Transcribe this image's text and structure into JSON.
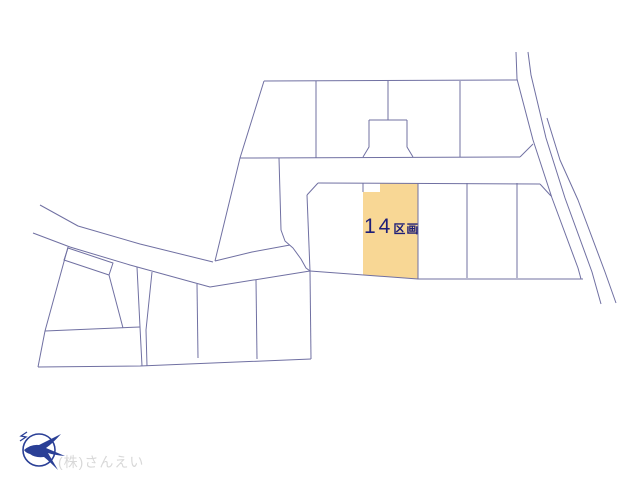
{
  "canvas": {
    "width": 640,
    "height": 480,
    "background": "#ffffff"
  },
  "colors": {
    "line": "#7070a2",
    "highlight_fill": "#f8d795",
    "label_color": "#1e1e78",
    "logo_color": "#2a3f96",
    "company_color": "#d8d8d8"
  },
  "parcel_label": {
    "number": "14",
    "suffix": "区画"
  },
  "footer": {
    "company_name": "(株)さんえい"
  },
  "plot_map": {
    "highlight_parcel": {
      "name": "parcel-14",
      "points": [
        [
          380,
          183
        ],
        [
          418,
          183
        ],
        [
          418,
          279
        ],
        [
          363,
          275
        ],
        [
          363,
          192
        ],
        [
          380,
          192
        ]
      ]
    },
    "lines": [
      {
        "name": "top-block-top-edge",
        "points": [
          [
            264,
            81
          ],
          [
            517,
            80
          ]
        ]
      },
      {
        "name": "top-block-left-edge",
        "points": [
          [
            264,
            81
          ],
          [
            240,
            158
          ],
          [
            215,
            261
          ]
        ]
      },
      {
        "name": "top-block-bottom-edge",
        "points": [
          [
            240,
            158
          ],
          [
            520,
            157
          ]
        ]
      },
      {
        "name": "top-block-corner-chamfer",
        "points": [
          [
            520,
            157
          ],
          [
            533,
            144
          ]
        ]
      },
      {
        "name": "top-block-divider-1",
        "points": [
          [
            316,
            81
          ],
          [
            316,
            158
          ]
        ]
      },
      {
        "name": "top-block-divider-2",
        "points": [
          [
            388,
            81
          ],
          [
            388,
            120
          ]
        ]
      },
      {
        "name": "flag-lot-top",
        "points": [
          [
            369,
            120
          ],
          [
            407,
            120
          ]
        ]
      },
      {
        "name": "flag-lot-left",
        "points": [
          [
            369,
            120
          ],
          [
            369,
            147
          ],
          [
            363,
            157
          ]
        ]
      },
      {
        "name": "flag-lot-right",
        "points": [
          [
            407,
            120
          ],
          [
            407,
            147
          ],
          [
            413,
            157
          ]
        ]
      },
      {
        "name": "top-block-divider-3",
        "points": [
          [
            460,
            81
          ],
          [
            460,
            157
          ]
        ]
      },
      {
        "name": "right-road-line-1",
        "points": [
          [
            516,
            52
          ],
          [
            517,
            79
          ],
          [
            533,
            140
          ],
          [
            552,
            198
          ],
          [
            578,
            268
          ],
          [
            581,
            279
          ]
        ]
      },
      {
        "name": "right-road-line-2",
        "points": [
          [
            528,
            52
          ],
          [
            531,
            75
          ],
          [
            546,
            138
          ],
          [
            565,
            198
          ],
          [
            592,
            272
          ],
          [
            601,
            304
          ]
        ]
      },
      {
        "name": "right-road-line-3",
        "points": [
          [
            547,
            118
          ],
          [
            560,
            160
          ],
          [
            578,
            200
          ],
          [
            605,
            272
          ],
          [
            616,
            303
          ]
        ]
      },
      {
        "name": "middle-block-top-edge",
        "points": [
          [
            318,
            183
          ],
          [
            540,
            184
          ]
        ]
      },
      {
        "name": "middle-block-right-chamfer",
        "points": [
          [
            540,
            184
          ],
          [
            551,
            196
          ]
        ]
      },
      {
        "name": "middle-block-left-chamfer",
        "points": [
          [
            318,
            183
          ],
          [
            307,
            195
          ]
        ]
      },
      {
        "name": "middle-block-left-edge",
        "points": [
          [
            307,
            195
          ],
          [
            310,
            271
          ]
        ]
      },
      {
        "name": "middle-block-bottom-edge",
        "points": [
          [
            310,
            271
          ],
          [
            418,
            279
          ],
          [
            583,
            279
          ]
        ]
      },
      {
        "name": "middle-block-divider-1",
        "points": [
          [
            418,
            183
          ],
          [
            418,
            279
          ]
        ]
      },
      {
        "name": "middle-block-divider-2",
        "points": [
          [
            467,
            183
          ],
          [
            467,
            278
          ]
        ]
      },
      {
        "name": "middle-block-divider-3",
        "points": [
          [
            517,
            183
          ],
          [
            517,
            278
          ]
        ]
      },
      {
        "name": "parcel-notch-stub",
        "points": [
          [
            363,
            183
          ],
          [
            363,
            192
          ]
        ]
      },
      {
        "name": "connector-road-edge",
        "points": [
          [
            279,
            158
          ],
          [
            281,
            230
          ],
          [
            285,
            241
          ],
          [
            293,
            248
          ],
          [
            301,
            259
          ],
          [
            306,
            268
          ],
          [
            310,
            271
          ]
        ]
      },
      {
        "name": "wedge-boundary",
        "points": [
          [
            215,
            261
          ],
          [
            252,
            252
          ],
          [
            290,
            245
          ]
        ]
      },
      {
        "name": "left-road-upper-edge",
        "points": [
          [
            40,
            205
          ],
          [
            78,
            226
          ],
          [
            140,
            244
          ],
          [
            213,
            262
          ]
        ]
      },
      {
        "name": "left-road-lower-edge",
        "points": [
          [
            33,
            233
          ],
          [
            70,
            247
          ],
          [
            130,
            265
          ],
          [
            210,
            287
          ],
          [
            310,
            271
          ]
        ]
      },
      {
        "name": "lower-block-left-edge",
        "points": [
          [
            68,
            247
          ],
          [
            45,
            331
          ],
          [
            38,
            367
          ]
        ]
      },
      {
        "name": "lower-block-bottom-edge",
        "points": [
          [
            38,
            367
          ],
          [
            140,
            366
          ],
          [
            311,
            359
          ]
        ]
      },
      {
        "name": "lower-block-right-edge",
        "points": [
          [
            311,
            359
          ],
          [
            310,
            271
          ]
        ]
      },
      {
        "name": "lower-block-small-lot",
        "points": [
          [
            68,
            248
          ],
          [
            113,
            263
          ],
          [
            109,
            275
          ],
          [
            64,
            260
          ],
          [
            68,
            248
          ]
        ]
      },
      {
        "name": "lower-block-diagonal",
        "points": [
          [
            109,
            275
          ],
          [
            123,
            328
          ]
        ]
      },
      {
        "name": "lower-block-inner-horizontal",
        "points": [
          [
            45,
            331
          ],
          [
            140,
            327
          ]
        ]
      },
      {
        "name": "lower-block-strip-left",
        "points": [
          [
            137,
            267
          ],
          [
            140,
            327
          ],
          [
            142,
            366
          ]
        ]
      },
      {
        "name": "lower-block-strip-right",
        "points": [
          [
            152,
            272
          ],
          [
            146,
            330
          ],
          [
            147,
            366
          ]
        ]
      },
      {
        "name": "lower-block-divider-1",
        "points": [
          [
            197,
            284
          ],
          [
            198,
            358
          ]
        ]
      },
      {
        "name": "lower-block-divider-2",
        "points": [
          [
            256,
            280
          ],
          [
            257,
            359
          ]
        ]
      }
    ]
  }
}
